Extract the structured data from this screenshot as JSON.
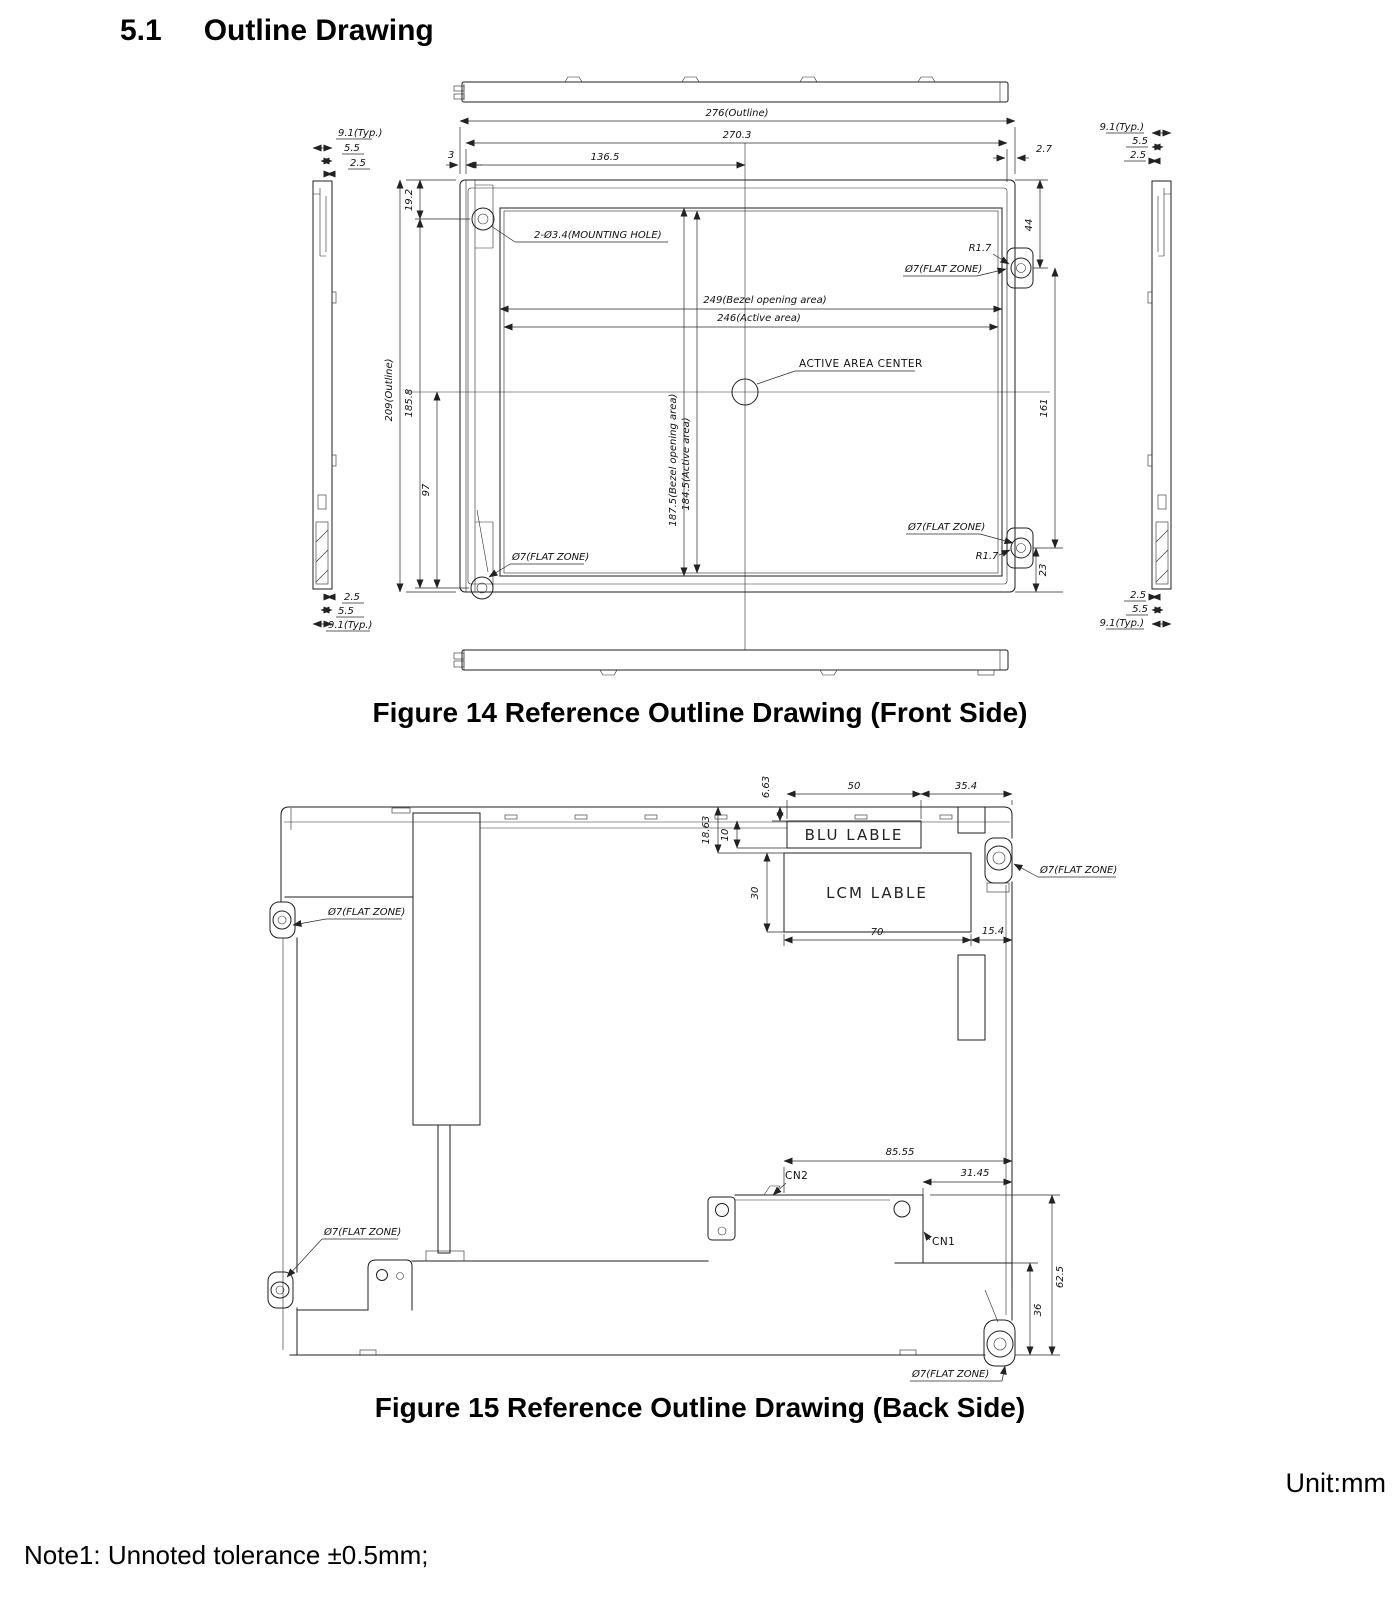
{
  "page": {
    "heading_number": "5.1",
    "heading_title": "Outline Drawing",
    "figure14_caption": "Figure 14  Reference Outline Drawing (Front Side)",
    "figure15_caption": "Figure 15  Reference Outline Drawing (Back Side)",
    "unit_label": "Unit:mm",
    "note1": "Note1: Unnoted tolerance ±0.5mm;"
  },
  "front": {
    "outline_width": "276(Outline)",
    "width_2703": "270.3",
    "width_1365": "136.5",
    "gap_3": "3",
    "gap_27": "2.7",
    "outline_height": "209(Outline)",
    "height_192": "19.2",
    "height_1858": "185.8",
    "height_97": "97",
    "height_44": "44",
    "height_161": "161",
    "height_23": "23",
    "bezel_open_w": "249(Bezel opening area)",
    "active_w": "246(Active area)",
    "bezel_open_h": "187.5(Bezel opening area)",
    "active_h": "184.5(Active area)",
    "active_center": "ACTIVE AREA CENTER",
    "mounting_hole": "2-Ø3.4(MOUNTING HOLE)",
    "r17": "R1.7",
    "flat_zone": "Ø7(FLAT ZONE)",
    "side_91": "9.1(Typ.)",
    "side_55": "5.5",
    "side_25": "2.5"
  },
  "back": {
    "blu_label": "BLU LABLE",
    "lcm_label": "LCM LABLE",
    "cn1": "CN1",
    "cn2": "CN2",
    "flat_zone": "Ø7(FLAT ZONE)",
    "d_663": "6.63",
    "d_50": "50",
    "d_354": "35.4",
    "d_1863": "18.63",
    "d_10": "10",
    "d_30": "30",
    "d_70": "70",
    "d_154": "15.4",
    "d_8555": "85.55",
    "d_3145": "31.45",
    "d_625": "62.5",
    "d_36": "36"
  }
}
